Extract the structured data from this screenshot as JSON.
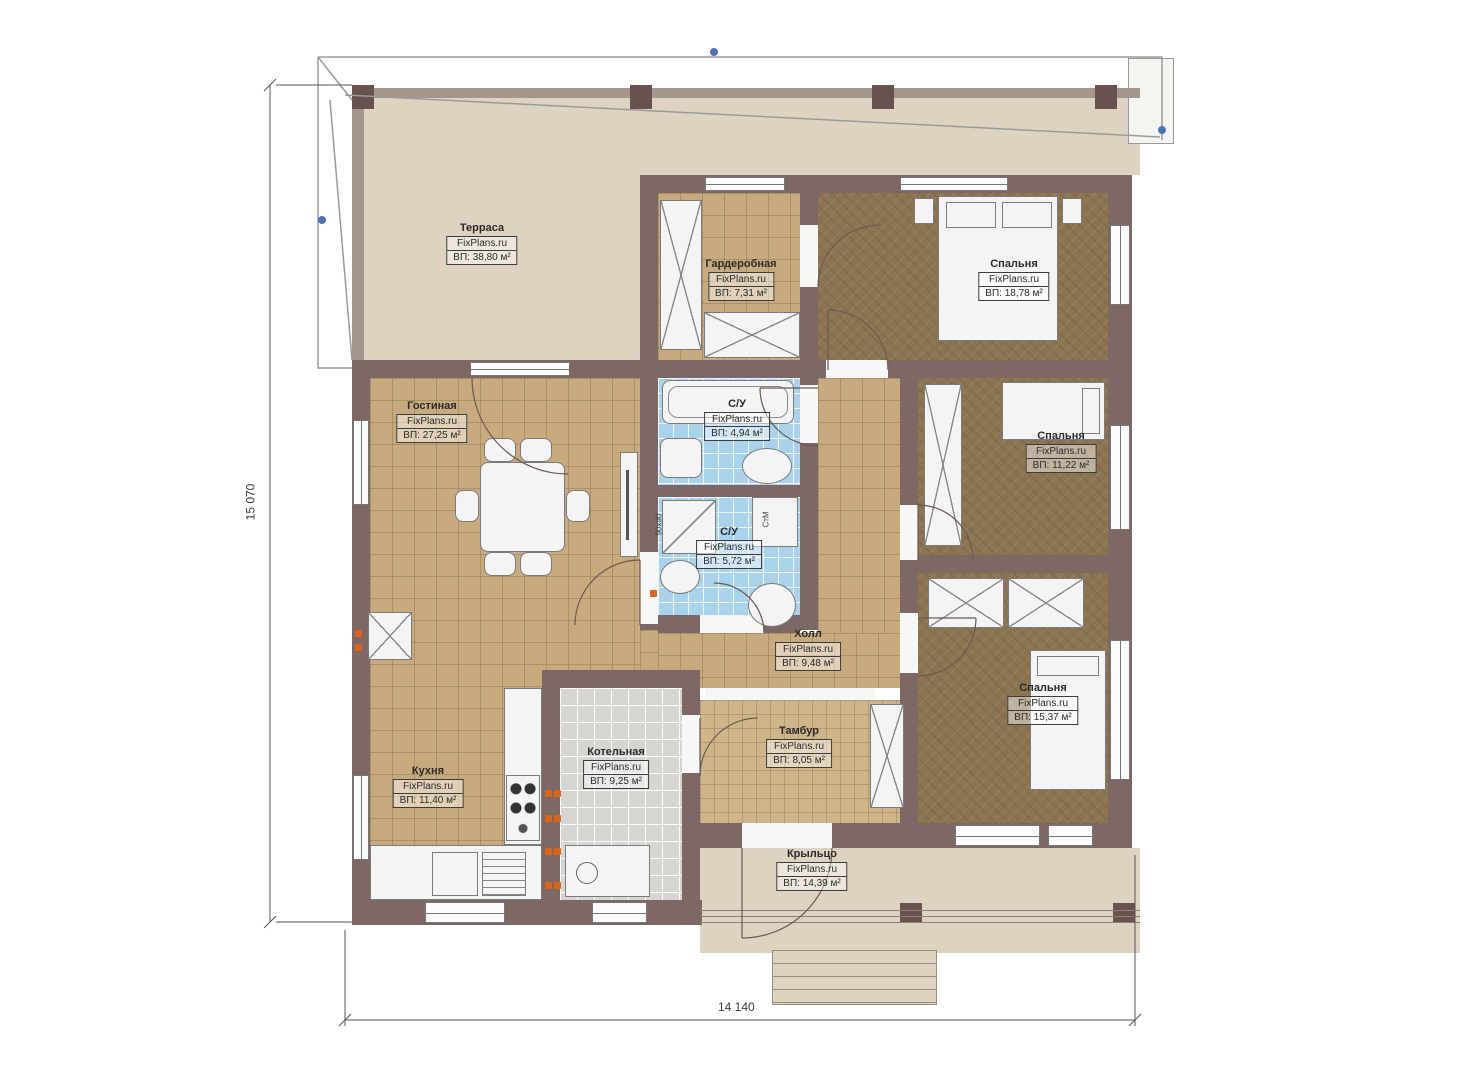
{
  "brand": "FixPlans.ru",
  "dimensions": {
    "left": "15 070",
    "bottom": "14 140"
  },
  "rooms": [
    {
      "name": "Терраса",
      "brand": "FixPlans.ru",
      "area": "ВП: 38,80 м²"
    },
    {
      "name": "Гардеробная",
      "brand": "FixPlans.ru",
      "area": "ВП: 7,31 м²"
    },
    {
      "name": "Спальня",
      "brand": "FixPlans.ru",
      "area": "ВП: 18,78 м²"
    },
    {
      "name": "Гостиная",
      "brand": "FixPlans.ru",
      "area": "ВП: 27,25 м²"
    },
    {
      "name": "С/У",
      "brand": "FixPlans.ru",
      "area": "ВП: 4,94 м²"
    },
    {
      "name": "Спальня",
      "brand": "FixPlans.ru",
      "area": "ВП: 11,22 м²"
    },
    {
      "name": "С/У",
      "brand": "FixPlans.ru",
      "area": "ВП: 5,72 м²"
    },
    {
      "name": "Холл",
      "brand": "FixPlans.ru",
      "area": "ВП: 9,48 м²"
    },
    {
      "name": "Тамбур",
      "brand": "FixPlans.ru",
      "area": "ВП: 8,05 м²"
    },
    {
      "name": "Спальня",
      "brand": "FixPlans.ru",
      "area": "ВП: 15,37 м²"
    },
    {
      "name": "Котельная",
      "brand": "FixPlans.ru",
      "area": "ВП: 9,25 м²"
    },
    {
      "name": "Кухня",
      "brand": "FixPlans.ru",
      "area": "ВП: 11,40 м²"
    },
    {
      "name": "Крыльцо",
      "brand": "FixPlans.ru",
      "area": "ВП: 14,39 м²"
    }
  ],
  "annotations": {
    "washing_machine": "СтМ",
    "shower_size": "90х90"
  },
  "colors": {
    "wall": "#7d6866",
    "terrace_floor": "#ded2c0",
    "tile_tan": "#c7ab7e",
    "bedroom_floor": "#8c7450",
    "bath_tile": "#a9d2ec",
    "boiler_tile": "#d6d5d2",
    "heater_orange": "#e06314",
    "marker_blue": "#4a74b5"
  }
}
